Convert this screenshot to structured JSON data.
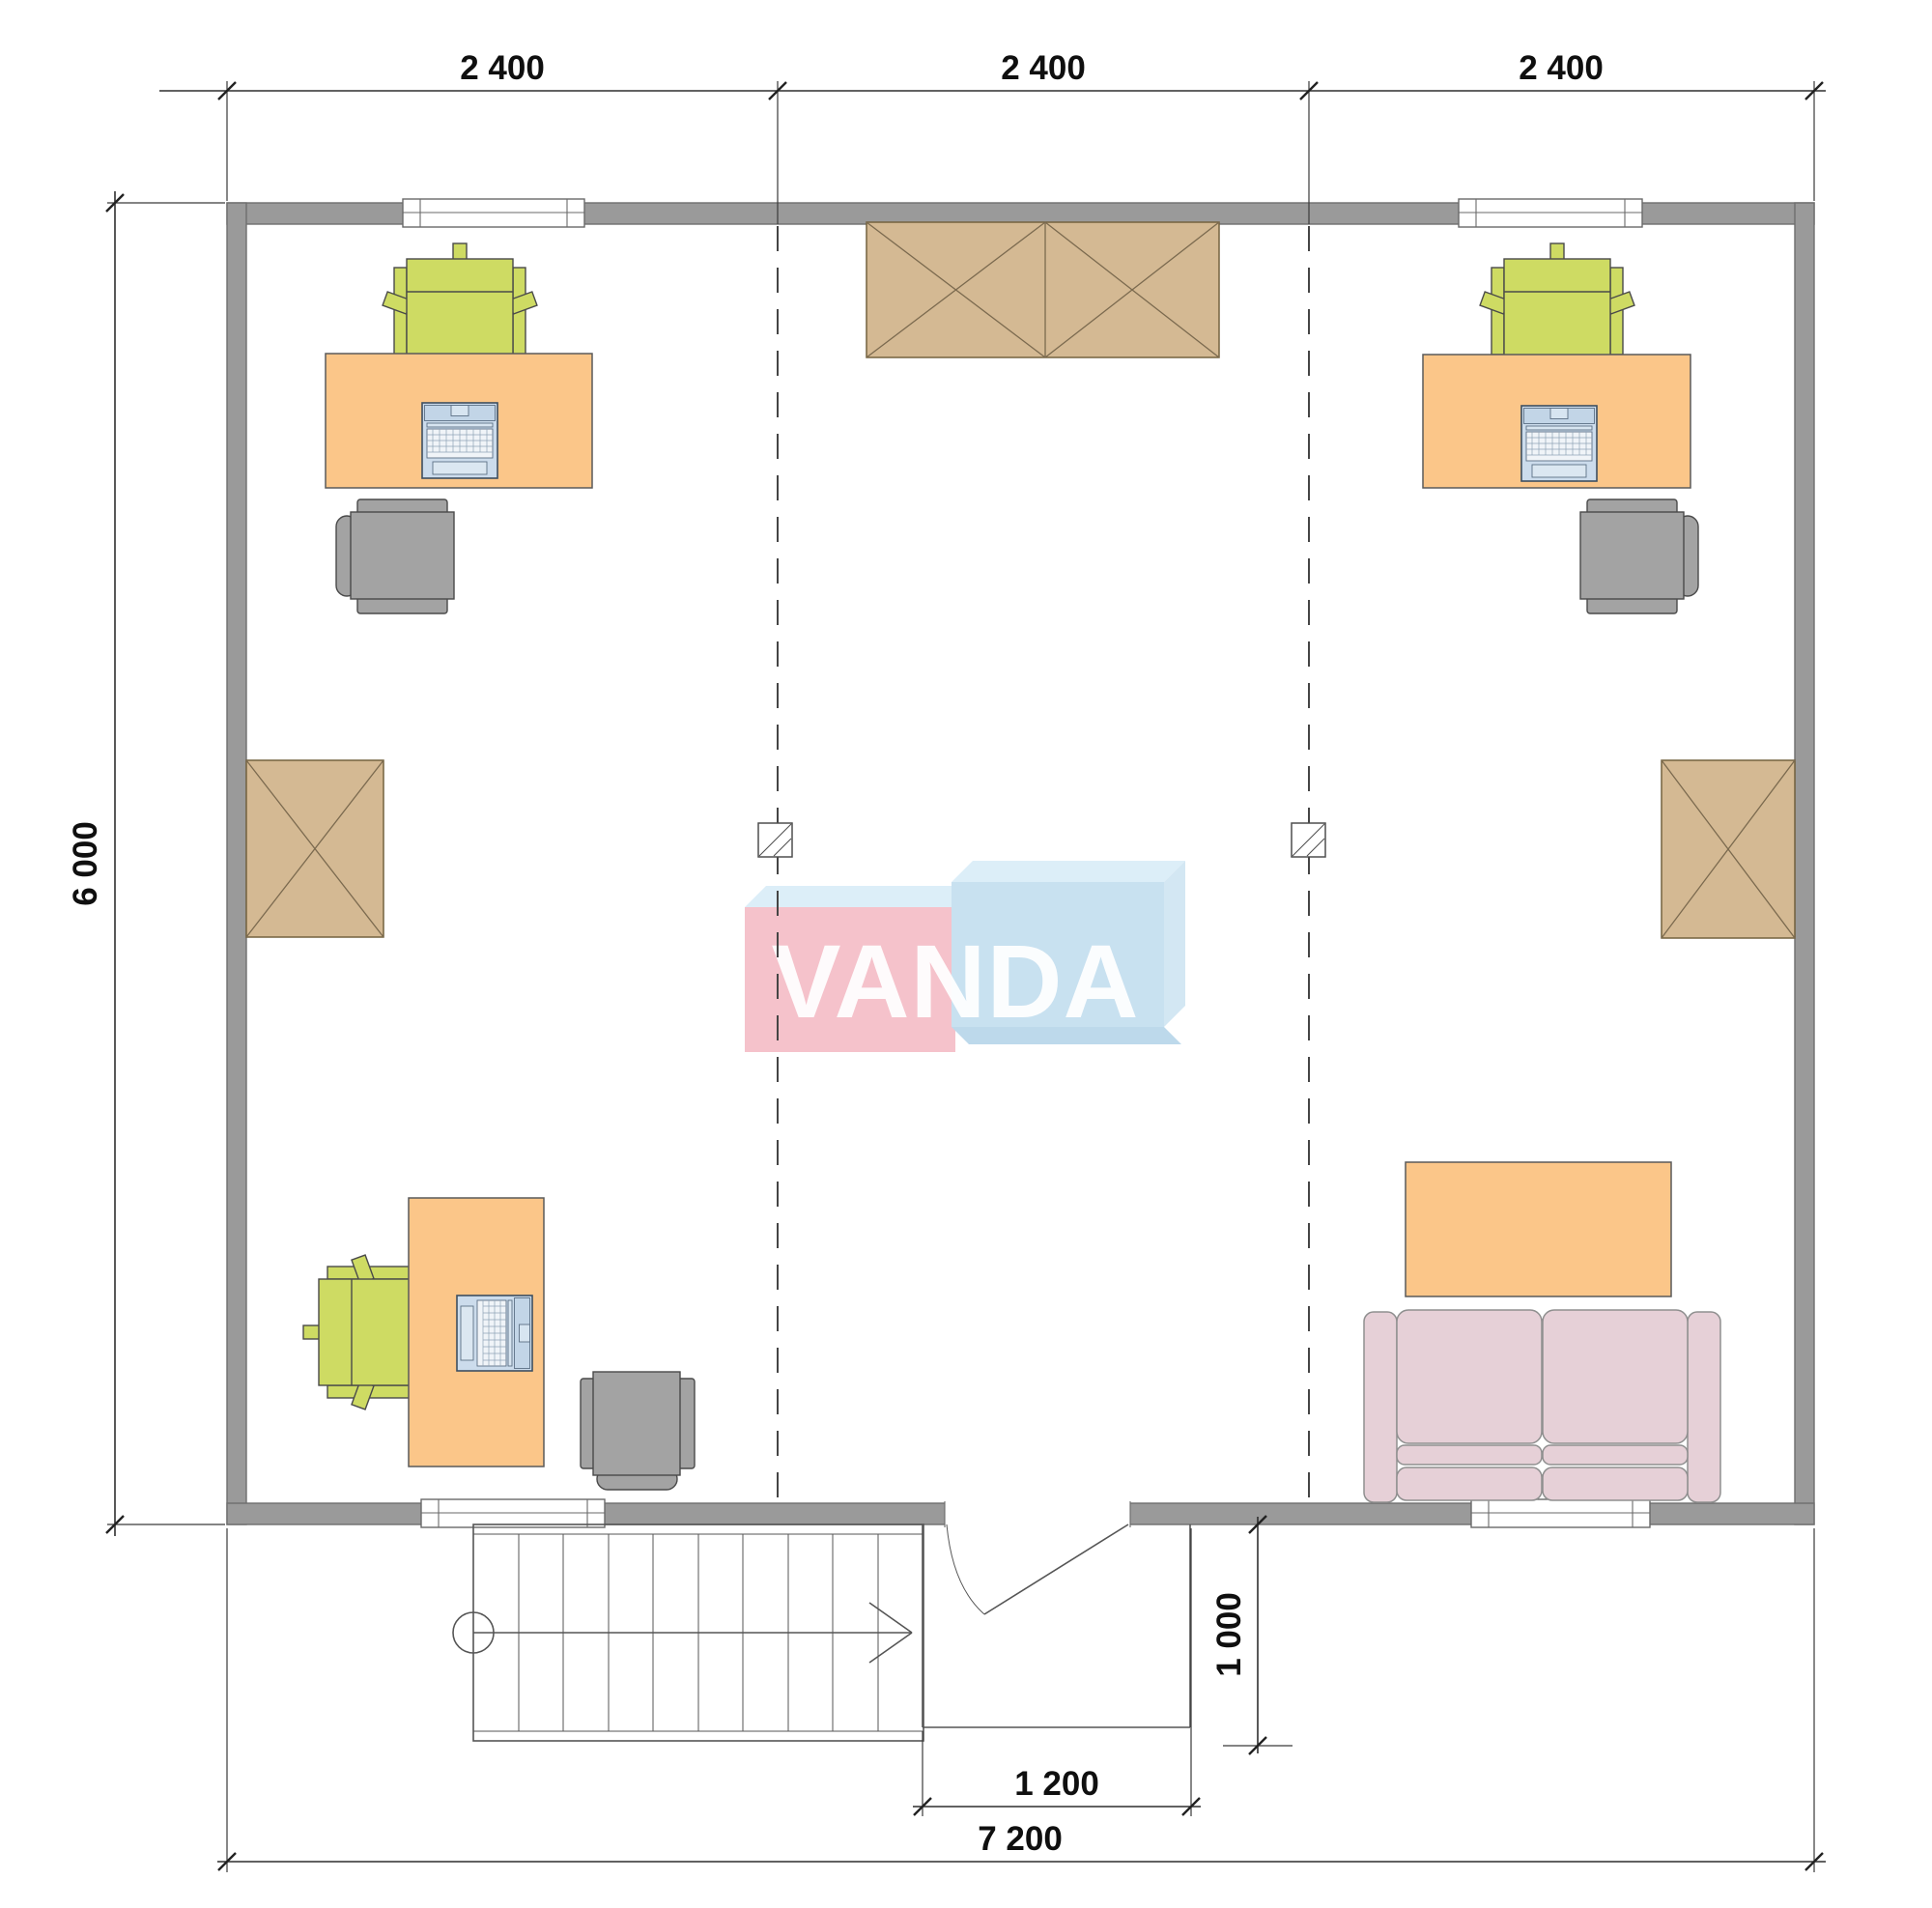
{
  "watermark": {
    "text": "VANDA",
    "pink": "#f4bac4",
    "blue": "#c1ddef",
    "bevel_light": "#d8ecf8",
    "bevel_mid": "#cde4f2",
    "bevel_dark": "#b5d4e9"
  },
  "dimensions": {
    "top_segments": [
      "2 400",
      "2 400",
      "2 400"
    ],
    "height_total": "6 000",
    "width_total": "7 200",
    "entry_width": "1 200",
    "entry_depth": "1 000"
  },
  "colors": {
    "wall": "#9a9a9a",
    "desk": "#fbc689",
    "chair_green": "#cedb63",
    "chair_gray": "#a3a3a3",
    "cabinet": "#d4b993",
    "sofa": "#e6d0d7",
    "laptop": "#ccdcec",
    "dimension_ink": "#2f2f2f"
  },
  "furniture": {
    "workstations_with_laptop": 3,
    "crossed_cabinets": 3,
    "sofa_count": 1,
    "coffee_tables": 1,
    "staircases": 1,
    "structural_columns": 2,
    "windows": 4,
    "doors": 1
  }
}
